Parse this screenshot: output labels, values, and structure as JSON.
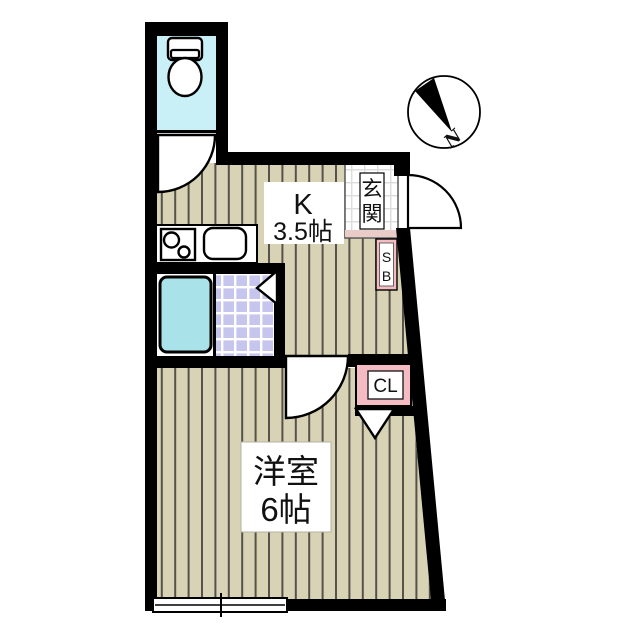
{
  "page": {
    "kind": "Japanese apartment floor plan",
    "background": "#ffffff"
  },
  "compass": {
    "label": "N"
  },
  "rooms": {
    "kitchen": {
      "label_line1": "K",
      "label_line2": "3.5帖"
    },
    "western_room": {
      "label_line1": "洋室",
      "label_line2": "6帖"
    },
    "entrance": {
      "label": "玄関",
      "char_top": "玄",
      "char_bottom": "関"
    },
    "shoe_box": {
      "abbr": "SB",
      "char_top": "S",
      "char_bottom": "B"
    },
    "closet": {
      "abbr": "CL"
    },
    "toilet": {
      "fixture": "toilet"
    },
    "bathroom": {
      "fixtures": "bathtub, tiled floor, door marker"
    }
  },
  "fixtures": {
    "kitchen_counter": "counter with two-burner stove and sink",
    "window_bottom": "sliding window on south wall",
    "doors": "entrance swing door, toilet swing door, room swing door"
  },
  "colors": {
    "wall": "#000000",
    "floor_stripe_bg": "#d8d3b5",
    "floor_stripe_line": "#54524a",
    "toilet_room": "#c9eff7",
    "bathtub": "#a9e2e8",
    "bath_tile": "#c5c5ee",
    "bath_tile_grid": "#ffffff",
    "entrance_tile": "#ffffff",
    "entrance_tile_grid": "#dcdcdc",
    "closet_pink": "#f4bcc2",
    "label_box": "#ffffff"
  }
}
